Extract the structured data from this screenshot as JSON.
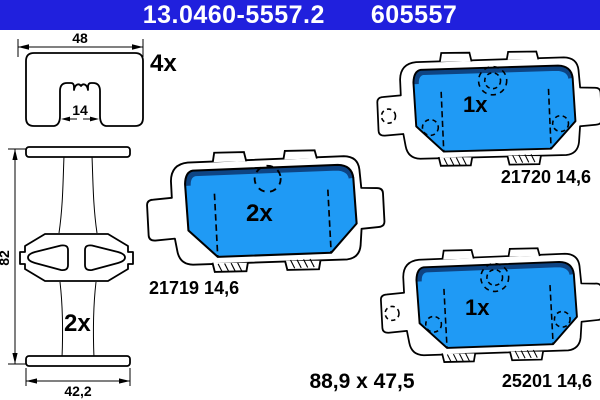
{
  "header": {
    "part_number": "13.0460-5557.2",
    "ean_number": "605557",
    "bg_color": "#2020dd",
    "text_color": "#ffffff"
  },
  "labels": {
    "shim_qty": "4x",
    "clip_qty": "2x",
    "pad_middle_qty": "2x",
    "pad_top_right_qty": "1x",
    "pad_bottom_right_qty": "1x",
    "pad_middle_part": "21719 14,6",
    "pad_top_right_part": "21720 14,6",
    "pad_bottom_right_part": "25201 14,6",
    "overall_dimensions": "88,9 x 47,5"
  },
  "dimensions": {
    "shim_width": "48",
    "shim_slot": "14",
    "clip_height": "82",
    "clip_width": "42,2"
  },
  "colors": {
    "pad_blue": "#1f9af5",
    "pad_blue_dark": "#0e4483",
    "line": "#000000"
  }
}
